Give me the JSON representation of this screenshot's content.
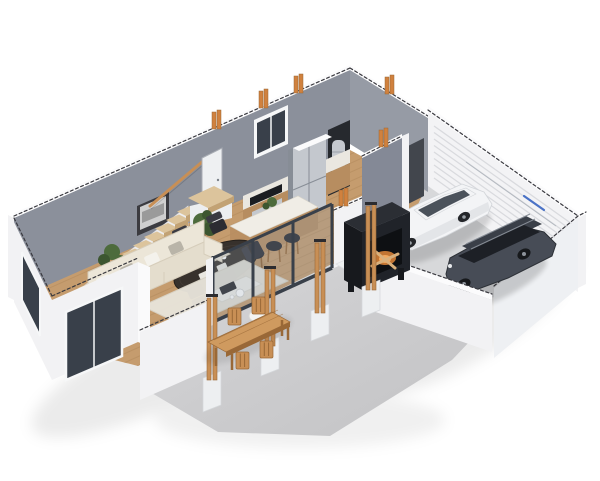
{
  "scene": {
    "type": "3d-floor-plan-render",
    "description": "Isometric 3D cutaway floor plan of a single-storey house on a white background: open-plan living room, dining area and kitchen with island, staircase along the back wall, utility hall with water heater, covered concrete patio with wooden pergola posts, outdoor dining table and outdoor fireplace, and an attached two-car garage with a white sedan and a dark SUV parked in front of a slatted garage door.",
    "background": "#ffffff"
  },
  "rooms": [
    {
      "id": "living-room",
      "label": "Living room",
      "floor": "wood",
      "objects": [
        "l-shaped-sofa",
        "throw-pillows",
        "area-rug",
        "coffee-table",
        "serving-tray",
        "side-stool",
        "console-table",
        "vase",
        "wall-picture",
        "potted-plants",
        "front-windows"
      ]
    },
    {
      "id": "dining-area",
      "label": "Dining area",
      "floor": "wood",
      "objects": [
        "oval-dining-table",
        "place-settings",
        "dining-chairs"
      ],
      "chair_count": 6
    },
    {
      "id": "kitchen",
      "label": "Kitchen",
      "floor": "wood",
      "objects": [
        "counter-cabinets",
        "cooktop",
        "range-oven",
        "refrigerator",
        "back-window",
        "kitchen-island",
        "bar-stools",
        "island-plant"
      ],
      "stool_count": 4
    },
    {
      "id": "staircase",
      "label": "Staircase",
      "objects": [
        "treads",
        "landing",
        "handrail",
        "door"
      ],
      "tread_count": 10
    },
    {
      "id": "utility-hall",
      "label": "Utility hall",
      "objects": [
        "water-heater-closet",
        "garage-doorway"
      ]
    },
    {
      "id": "garage",
      "label": "Garage",
      "floor": "concrete",
      "objects": [
        "slatted-garage-door",
        "door-track",
        "white-sedan",
        "dark-suv"
      ],
      "car_count": 2
    },
    {
      "id": "patio",
      "label": "Covered patio",
      "floor": "concrete",
      "objects": [
        "pergola-posts",
        "post-pedestals",
        "outdoor-dining-table",
        "outdoor-chairs",
        "outdoor-fireplace",
        "firewood"
      ],
      "post_count": 4,
      "outdoor_chair_count": 4
    }
  ],
  "vehicles": [
    {
      "id": "sedan",
      "body_color_name": "white",
      "position": "garage-left"
    },
    {
      "id": "suv",
      "body_color_name": "dark-gray",
      "position": "garage-right"
    }
  ],
  "palette": {
    "bg": "#ffffff",
    "wallGray": "#8b909b",
    "wallGrayDark": "#848996",
    "hallWall": "#969ba5",
    "wallWhite": "#f2f2f4",
    "wallTop": "#fbfbfc",
    "cutLine": "#3a3a40",
    "woodFloor": "#c59c6e",
    "woodLine": "#a37b4f",
    "stairWood": "#dcc49c",
    "stairFace": "#c2a274",
    "concrete": "#c8c8ca",
    "concreteLight": "#d7d8da",
    "glass": "#39404a",
    "glassTint": "#8fa0ac",
    "frameWhite": "#f6f7f8",
    "sofa": "#ece6d8",
    "sofaShade": "#d6cdbb",
    "pillow": "#f4f2ec",
    "pillowGray": "#b9b4a8",
    "rug": "#e8e4da",
    "tableDark": "#37312c",
    "chairBlack": "#2c2c32",
    "marble": "#f0ede6",
    "cabinet": "#b78d60",
    "steel": "#c4c8ce",
    "steelDark": "#878d96",
    "postWood": "#c88f55",
    "postWoodDark": "#996837",
    "pedestal": "#edeff1",
    "fireBox": "#202329",
    "fireGlow": "#e2873a",
    "log": "#d9b07c",
    "carWhite": "#f3f4f6",
    "carShade": "#d8dbdf",
    "suv": "#474c56",
    "suvDark": "#2f333a",
    "doorWhite": "#eef0f2",
    "garageDoor": "#f3f3f5",
    "garageLine": "#d9dade",
    "trackBlue": "#4a72c6",
    "stud": "#d0813e",
    "plant": "#4d6b3c",
    "plantDark": "#3c5630",
    "eastWall": "#eef0f3"
  }
}
